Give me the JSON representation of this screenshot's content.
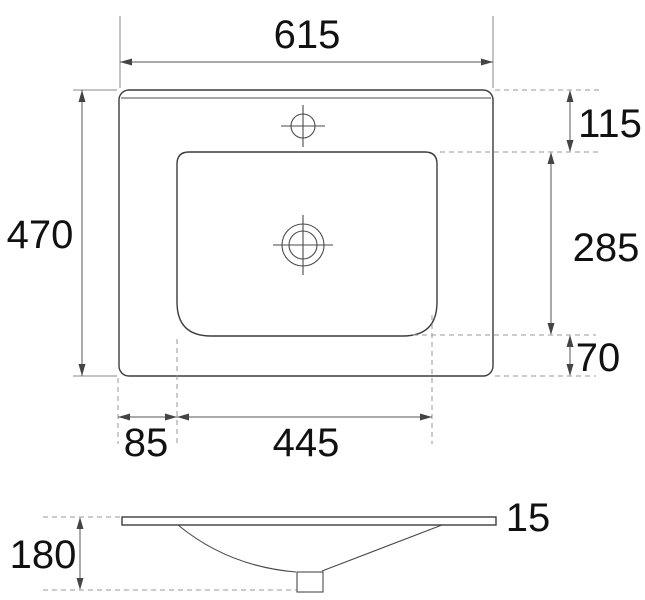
{
  "drawing": {
    "kind": "technical-drawing",
    "subject": "vanity washbasin dimension drawing, top view and side section view",
    "units_shown": false
  },
  "dimensions": {
    "overall_width": "615",
    "overall_depth": "470",
    "back_edge_to_basin": "115",
    "basin_depth": "285",
    "basin_to_front_edge": "70",
    "side_offset": "85",
    "basin_width": "445",
    "rim_thickness": "15",
    "total_height": "180"
  },
  "colors": {
    "background": "#ffffff",
    "line": "#3c3c3c",
    "dashed_line": "#9a9a9a",
    "text": "#111111"
  }
}
